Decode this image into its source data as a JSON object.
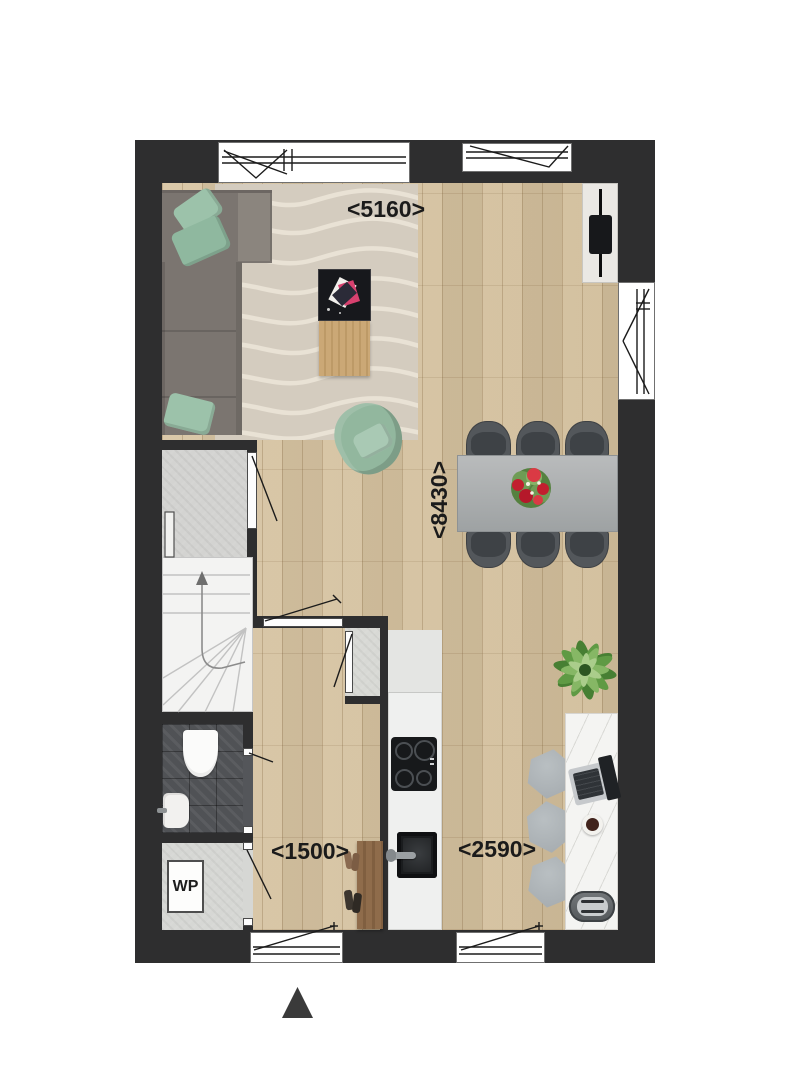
{
  "labels": {
    "dim_living_width": "<5160>",
    "dim_total_depth": "<8430>",
    "dim_hall_width": "<1500>",
    "dim_kitchen_width": "<2590>",
    "wp_unit": "WP"
  },
  "icons": {
    "north_arrow": "triangle-up"
  },
  "colors": {
    "background": "#ffffff",
    "wall": "#2e2e2f",
    "wood_floor": "#d6c3a1",
    "rug": "#d4ccbf",
    "rug_wave": "#ece5d8",
    "sofa": "#7b7570",
    "accent_green": "#95b9a1",
    "dining_table": "#aaaeaf",
    "chair": "#4c5054",
    "tile_floor": "#54565a",
    "counter": "#eff0ef",
    "stairs": "#f3f3f2",
    "hall_floor": "#d3d3d1",
    "desk_marble": "#f4f4f2",
    "bench_wood": "#8a6747",
    "flower_red": "#c62632",
    "plant_green": "#5f9a44"
  }
}
